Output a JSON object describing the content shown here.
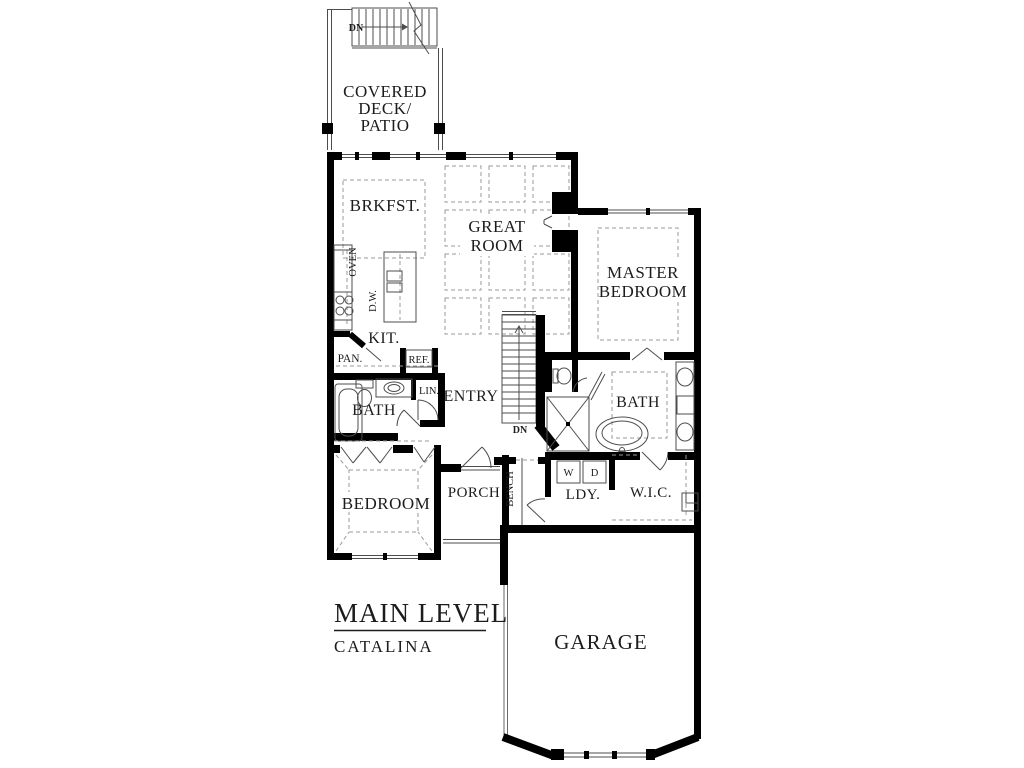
{
  "title_block": {
    "title": "MAIN LEVEL",
    "subtitle": "CATALINA"
  },
  "rooms": {
    "covered_deck": [
      "COVERED",
      "DECK/",
      "PATIO"
    ],
    "breakfast": "BRKFST.",
    "great_room": [
      "GREAT",
      "ROOM"
    ],
    "master_bedroom": [
      "MASTER",
      "BEDROOM"
    ],
    "kitchen": "KIT.",
    "entry": "ENTRY",
    "hall_bath": "BATH",
    "master_bath": "BATH",
    "bedroom": "BEDROOM",
    "porch": "PORCH",
    "laundry": "LDY.",
    "walk_in_closet": "W.I.C.",
    "garage": "GARAGE"
  },
  "fixtures": {
    "oven": "OVEN",
    "dishwasher": "D.W.",
    "pantry": "PAN.",
    "refrigerator": "REF.",
    "linen": "LIN.",
    "bench": "BENCH",
    "washer": "W",
    "dryer": "D"
  },
  "stairs": {
    "down_upper": "DN",
    "down_main": "DN"
  },
  "colors": {
    "wall": "#000000",
    "thin_line": "#4d4d4d",
    "dashed_line": "#9a9a9a",
    "text": "#1c1c1c",
    "background": "#ffffff"
  }
}
